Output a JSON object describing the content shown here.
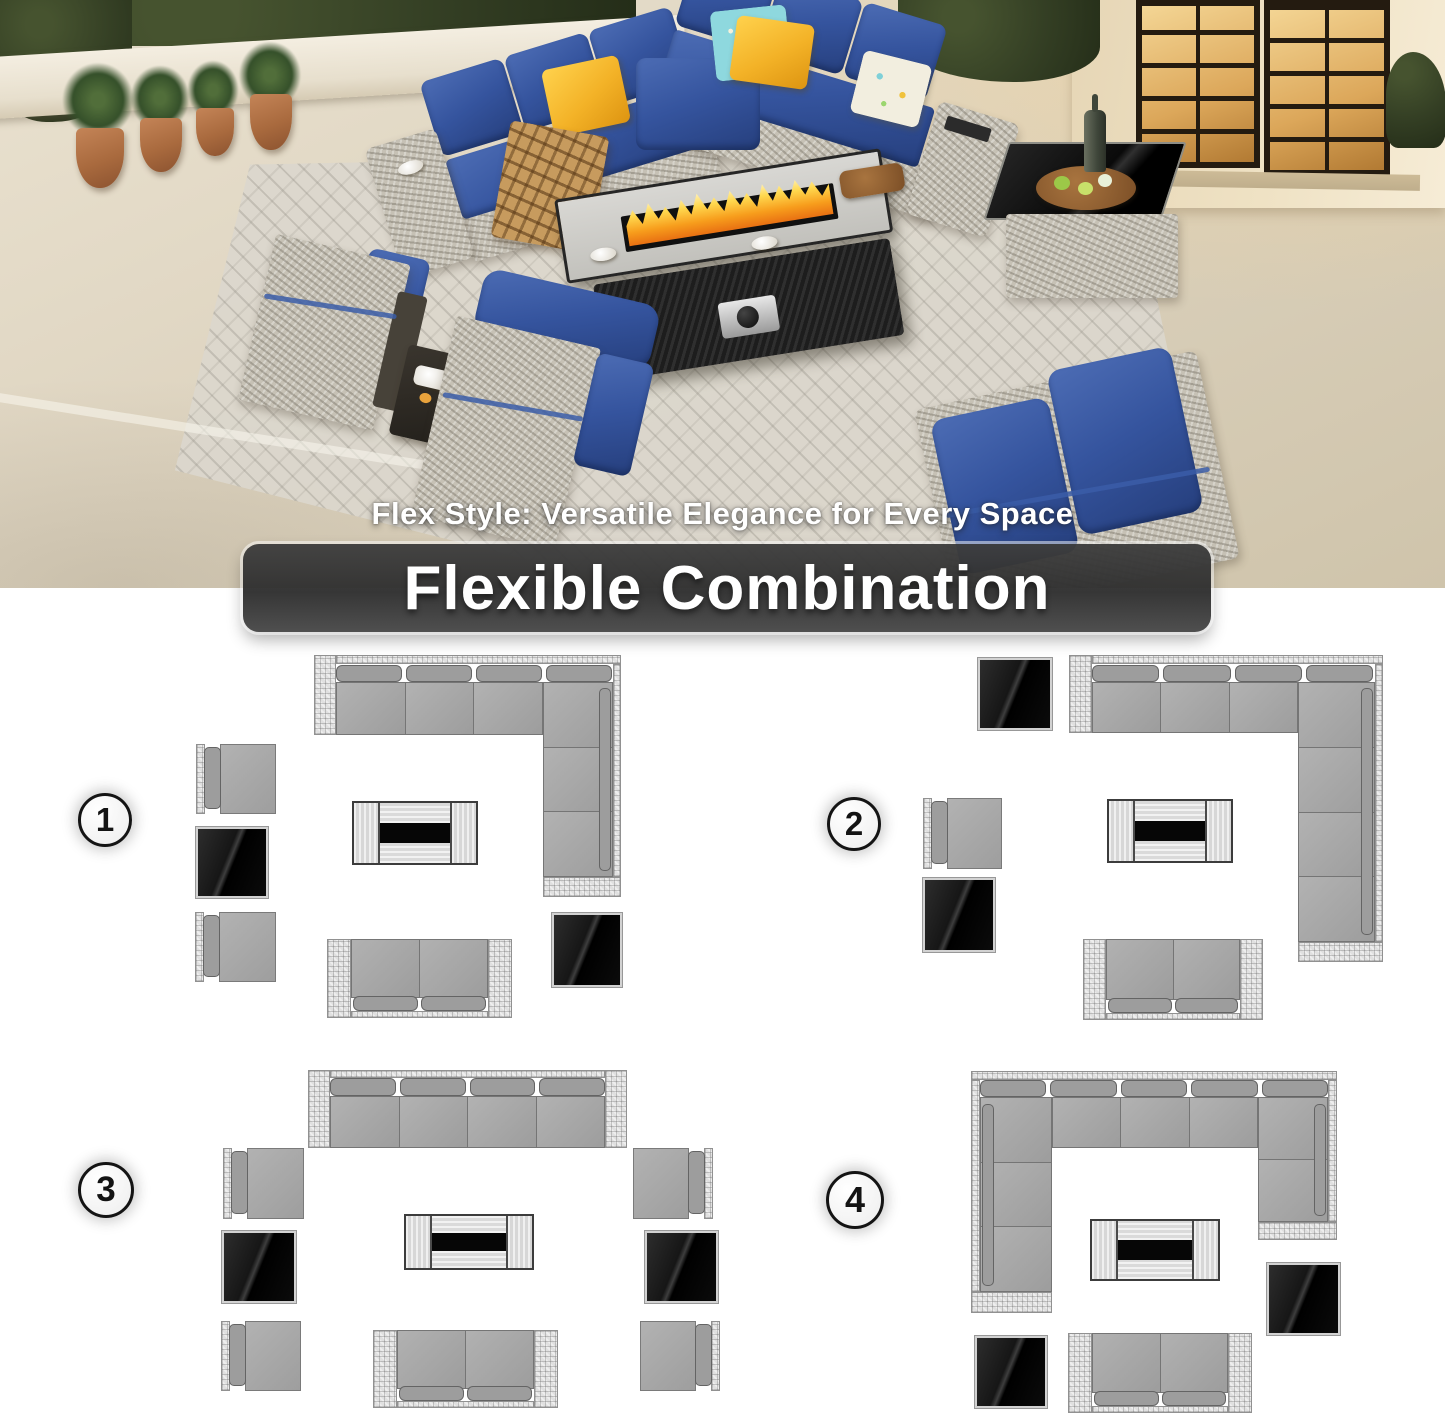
{
  "hero": {
    "tagline": "Flex Style: Versatile Elegance for Every Space",
    "banner_title": "Flexible Combination"
  },
  "palette": {
    "cushion_navy": "#35549e",
    "pillow_yellow": "#f3b227",
    "pillow_teal": "#8ed8de",
    "flame_orange": "#f79d1c",
    "wicker_gray": "#c6c1b5",
    "floor_beige": "#ddd3bf",
    "banner_gray": "#3e3e3e",
    "diagram_seat_gray": "#a9a9a9",
    "glass_black": "#0a0a0a"
  },
  "diagrams": [
    {
      "number": "1",
      "badge": {
        "x": 78,
        "y": 793,
        "d": 54
      },
      "pieces": [
        {
          "name": "corner-sectional",
          "type": "sectional",
          "parts": [
            {
              "k": "wicker",
              "x": 314,
              "y": 655,
              "w": 22,
              "h": 80
            },
            {
              "k": "wicker",
              "x": 336,
              "y": 655,
              "w": 285,
              "h": 9
            },
            {
              "k": "wicker",
              "x": 613,
              "y": 664,
              "w": 8,
              "h": 213
            },
            {
              "k": "wicker",
              "x": 543,
              "y": 877,
              "w": 78,
              "h": 20
            },
            {
              "k": "backs",
              "x": 336,
              "y": 665,
              "w": 276,
              "h": 17,
              "n": 4,
              "dir": "h"
            },
            {
              "k": "seats",
              "x": 336,
              "y": 682,
              "w": 207,
              "h": 53,
              "n": 3,
              "dir": "h"
            },
            {
              "k": "seats",
              "x": 543,
              "y": 682,
              "w": 70,
              "h": 195,
              "n": 3,
              "dir": "v"
            },
            {
              "k": "backpad",
              "x": 599,
              "y": 688,
              "w": 12,
              "h": 183
            }
          ]
        },
        {
          "name": "armchair-top",
          "type": "armchair",
          "x": 196,
          "y": 744,
          "w": 80,
          "h": 70,
          "facing": "right"
        },
        {
          "name": "side-table-left",
          "type": "sidetable",
          "x": 196,
          "y": 827,
          "w": 72,
          "h": 71
        },
        {
          "name": "armchair-bottom",
          "type": "armchair",
          "x": 195,
          "y": 912,
          "w": 81,
          "h": 70,
          "facing": "right"
        },
        {
          "name": "fire-pit-table",
          "type": "firetable",
          "x": 352,
          "y": 801,
          "w": 126,
          "h": 64
        },
        {
          "name": "loveseat",
          "type": "loveseat",
          "x": 327,
          "y": 939,
          "w": 185,
          "h": 79
        },
        {
          "name": "side-table-right",
          "type": "sidetable",
          "x": 552,
          "y": 913,
          "w": 70,
          "h": 74
        }
      ]
    },
    {
      "number": "2",
      "badge": {
        "x": 827,
        "y": 797,
        "d": 54
      },
      "pieces": [
        {
          "name": "side-table-top",
          "type": "sidetable",
          "x": 978,
          "y": 658,
          "w": 74,
          "h": 72
        },
        {
          "name": "corner-sectional",
          "type": "sectional",
          "parts": [
            {
              "k": "wicker",
              "x": 1069,
              "y": 655,
              "w": 23,
              "h": 78
            },
            {
              "k": "wicker",
              "x": 1092,
              "y": 655,
              "w": 291,
              "h": 9
            },
            {
              "k": "wicker",
              "x": 1375,
              "y": 664,
              "w": 8,
              "h": 278
            },
            {
              "k": "wicker",
              "x": 1298,
              "y": 942,
              "w": 85,
              "h": 20
            },
            {
              "k": "backs",
              "x": 1092,
              "y": 665,
              "w": 281,
              "h": 17,
              "n": 4,
              "dir": "h"
            },
            {
              "k": "seats",
              "x": 1092,
              "y": 682,
              "w": 206,
              "h": 51,
              "n": 3,
              "dir": "h"
            },
            {
              "k": "seats",
              "x": 1298,
              "y": 682,
              "w": 77,
              "h": 260,
              "n": 4,
              "dir": "v"
            },
            {
              "k": "backpad",
              "x": 1361,
              "y": 688,
              "w": 12,
              "h": 247
            }
          ]
        },
        {
          "name": "armchair",
          "type": "armchair",
          "x": 923,
          "y": 798,
          "w": 79,
          "h": 71,
          "facing": "right"
        },
        {
          "name": "side-table-bottom",
          "type": "sidetable",
          "x": 923,
          "y": 878,
          "w": 72,
          "h": 74
        },
        {
          "name": "fire-pit-table",
          "type": "firetable",
          "x": 1107,
          "y": 799,
          "w": 126,
          "h": 64
        },
        {
          "name": "loveseat",
          "type": "loveseat",
          "x": 1083,
          "y": 939,
          "w": 180,
          "h": 81
        }
      ]
    },
    {
      "number": "3",
      "badge": {
        "x": 78,
        "y": 1162,
        "d": 56
      },
      "pieces": [
        {
          "name": "four-seat-sofa",
          "type": "sectional",
          "parts": [
            {
              "k": "wicker",
              "x": 308,
              "y": 1070,
              "w": 22,
              "h": 78
            },
            {
              "k": "wicker",
              "x": 605,
              "y": 1070,
              "w": 22,
              "h": 78
            },
            {
              "k": "wicker",
              "x": 330,
              "y": 1070,
              "w": 275,
              "h": 8
            },
            {
              "k": "backs",
              "x": 330,
              "y": 1078,
              "w": 275,
              "h": 18,
              "n": 4,
              "dir": "h"
            },
            {
              "k": "seats",
              "x": 330,
              "y": 1096,
              "w": 275,
              "h": 52,
              "n": 4,
              "dir": "h"
            }
          ]
        },
        {
          "name": "armchair-left-top",
          "type": "armchair",
          "x": 223,
          "y": 1148,
          "w": 81,
          "h": 71,
          "facing": "right"
        },
        {
          "name": "side-table-left",
          "type": "sidetable",
          "x": 222,
          "y": 1231,
          "w": 74,
          "h": 72
        },
        {
          "name": "armchair-left-bottom",
          "type": "armchair",
          "x": 221,
          "y": 1321,
          "w": 80,
          "h": 70,
          "facing": "right"
        },
        {
          "name": "armchair-right-top",
          "type": "armchair",
          "x": 633,
          "y": 1148,
          "w": 80,
          "h": 71,
          "facing": "left"
        },
        {
          "name": "side-table-right",
          "type": "sidetable",
          "x": 645,
          "y": 1231,
          "w": 73,
          "h": 72
        },
        {
          "name": "armchair-right-bottom",
          "type": "armchair",
          "x": 640,
          "y": 1321,
          "w": 80,
          "h": 70,
          "facing": "left"
        },
        {
          "name": "fire-pit-table",
          "type": "firetable",
          "x": 404,
          "y": 1214,
          "w": 130,
          "h": 56
        },
        {
          "name": "loveseat",
          "type": "loveseat",
          "x": 373,
          "y": 1330,
          "w": 185,
          "h": 78
        }
      ]
    },
    {
      "number": "4",
      "badge": {
        "x": 826,
        "y": 1171,
        "d": 58
      },
      "pieces": [
        {
          "name": "u-sectional",
          "type": "sectional",
          "parts": [
            {
              "k": "wicker",
              "x": 971,
              "y": 1071,
              "w": 366,
              "h": 9
            },
            {
              "k": "wicker",
              "x": 971,
              "y": 1080,
              "w": 9,
              "h": 212
            },
            {
              "k": "wicker",
              "x": 1328,
              "y": 1080,
              "w": 9,
              "h": 142
            },
            {
              "k": "wicker",
              "x": 971,
              "y": 1292,
              "w": 81,
              "h": 21
            },
            {
              "k": "wicker",
              "x": 1258,
              "y": 1222,
              "w": 79,
              "h": 18
            },
            {
              "k": "backs",
              "x": 980,
              "y": 1080,
              "w": 348,
              "h": 17,
              "n": 5,
              "dir": "h"
            },
            {
              "k": "seats",
              "x": 1052,
              "y": 1097,
              "w": 206,
              "h": 51,
              "n": 3,
              "dir": "h"
            },
            {
              "k": "seats",
              "x": 980,
              "y": 1097,
              "w": 72,
              "h": 195,
              "n": 3,
              "dir": "v"
            },
            {
              "k": "seats",
              "x": 1258,
              "y": 1097,
              "w": 70,
              "h": 125,
              "n": 2,
              "dir": "v"
            },
            {
              "k": "backpad",
              "x": 982,
              "y": 1104,
              "w": 12,
              "h": 182
            },
            {
              "k": "backpad",
              "x": 1314,
              "y": 1104,
              "w": 12,
              "h": 112
            }
          ]
        },
        {
          "name": "fire-pit-table",
          "type": "firetable",
          "x": 1090,
          "y": 1219,
          "w": 130,
          "h": 62
        },
        {
          "name": "side-table-right",
          "type": "sidetable",
          "x": 1267,
          "y": 1263,
          "w": 73,
          "h": 72
        },
        {
          "name": "side-table-bottom",
          "type": "sidetable",
          "x": 975,
          "y": 1336,
          "w": 72,
          "h": 72
        },
        {
          "name": "loveseat",
          "type": "loveseat",
          "x": 1068,
          "y": 1333,
          "w": 184,
          "h": 80
        }
      ]
    }
  ]
}
